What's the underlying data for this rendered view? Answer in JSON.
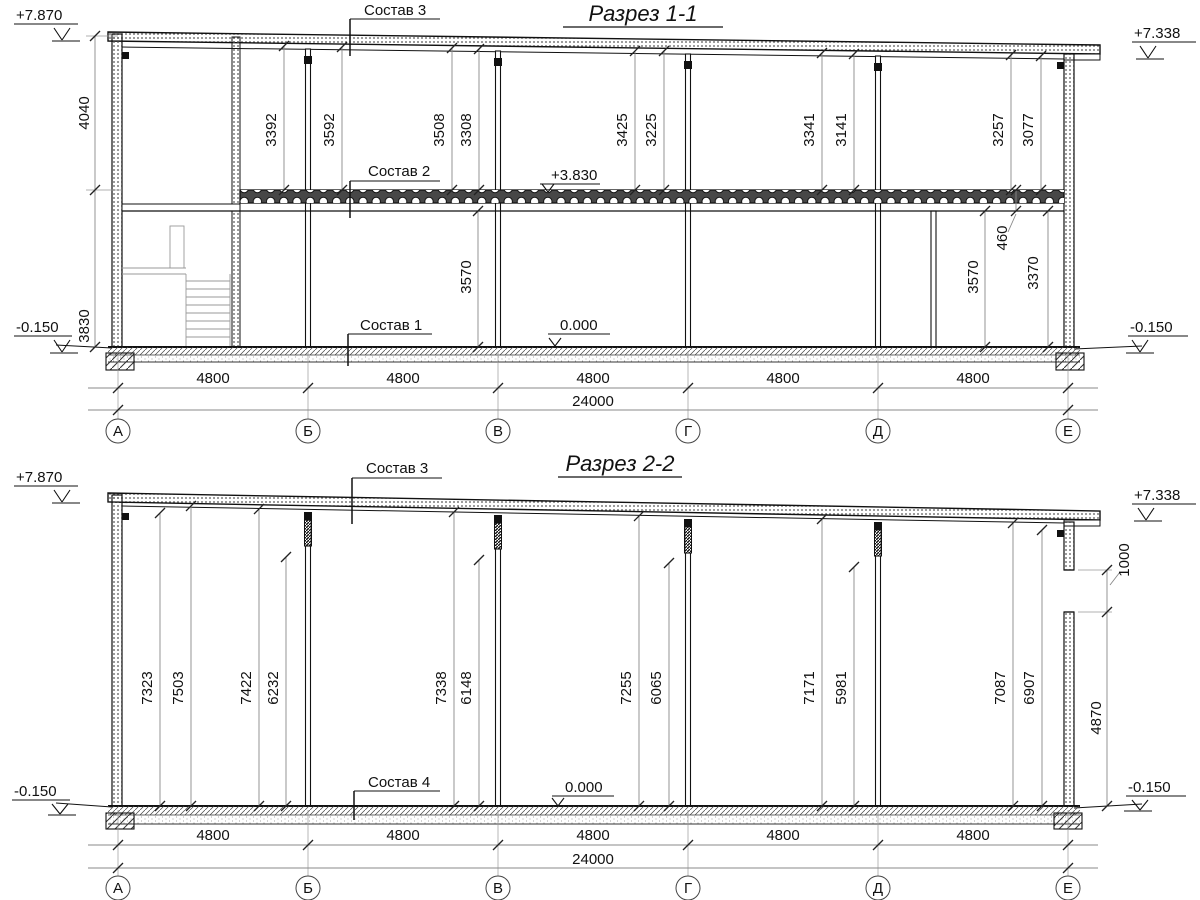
{
  "s1": {
    "title": "Разрез 1-1",
    "elev": {
      "tl": "+7.870",
      "tr": "+7.338",
      "bl": "-0.150",
      "br": "-0.150",
      "slab": "+3.830",
      "floor": "0.000"
    },
    "labels": {
      "l1": "Состав 1",
      "l2": "Состав 2",
      "l3": "Состав 3"
    },
    "left_dims": [
      "4040",
      "3830"
    ],
    "bay_dims": [
      "3392",
      "3592",
      "3508",
      "3308",
      "3425",
      "3225",
      "3341",
      "3141",
      "3257",
      "3077"
    ],
    "lower_dims": [
      "3570",
      "3570",
      "3370",
      "460"
    ],
    "span_dims": [
      "4800",
      "4800",
      "4800",
      "4800",
      "4800"
    ],
    "total_dim": "24000",
    "axes": [
      "А",
      "Б",
      "В",
      "Г",
      "Д",
      "Е"
    ]
  },
  "s2": {
    "title": "Разрез 2-2",
    "elev": {
      "tl": "+7.870",
      "tr": "+7.338",
      "bl": "-0.150",
      "br": "-0.150",
      "floor": "0.000"
    },
    "labels": {
      "l3": "Состав 3",
      "l4": "Состав 4"
    },
    "bay_dims": [
      "7323",
      "7503",
      "7422",
      "6232",
      "7338",
      "6148",
      "7255",
      "6065",
      "7171",
      "5981",
      "7087",
      "6907"
    ],
    "right_dims": [
      "1000",
      "4870"
    ],
    "span_dims": [
      "4800",
      "4800",
      "4800",
      "4800",
      "4800"
    ],
    "total_dim": "24000",
    "axes": [
      "А",
      "Б",
      "В",
      "Г",
      "Д",
      "Е"
    ]
  }
}
